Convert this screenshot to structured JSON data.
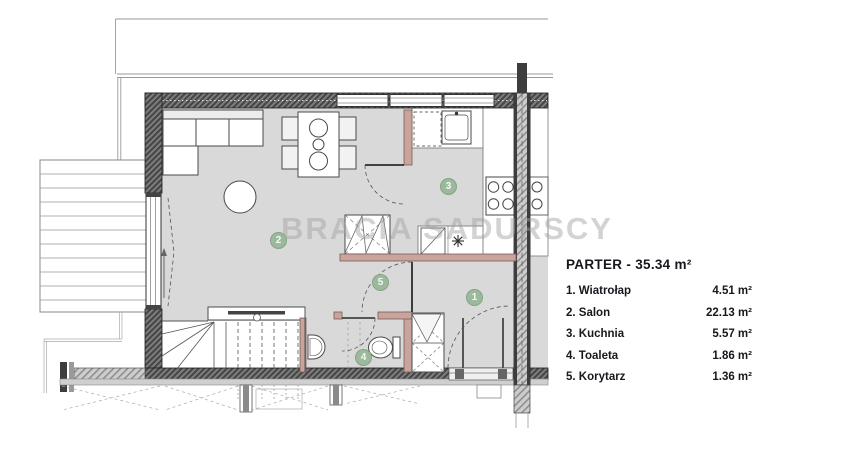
{
  "watermark": "BRACIA SADURSCY",
  "legend": {
    "title": "PARTER - 35.34 m²",
    "rooms": [
      {
        "label": "1. Wiatrołap",
        "area": "4.51 m²"
      },
      {
        "label": "2. Salon",
        "area": "22.13 m²"
      },
      {
        "label": "3. Kuchnia",
        "area": "5.57 m²"
      },
      {
        "label": "4. Toaleta",
        "area": "1.86 m²"
      },
      {
        "label": "5. Korytarz",
        "area": "1.36 m²"
      }
    ]
  },
  "badges": [
    "1",
    "2",
    "3",
    "4",
    "5"
  ],
  "colors": {
    "badge_green": "#9db99d",
    "partition_salmon": "#c9a49c",
    "floor_gray": "#d9d9d9",
    "wall_dark": "#555555",
    "text_dark": "#17171d",
    "watermark_gray": "#a0a0a0"
  }
}
